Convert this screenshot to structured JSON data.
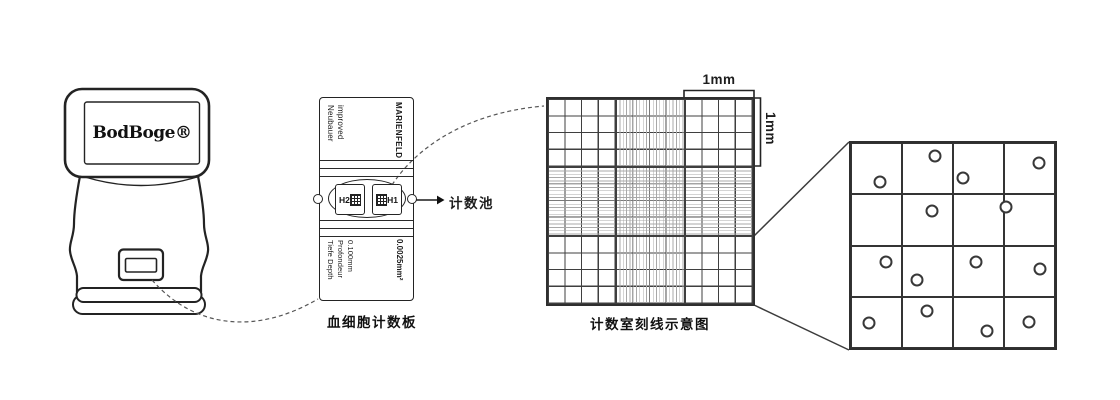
{
  "device": {
    "logo": "BodBoge®"
  },
  "slide": {
    "brand_lines": [
      "Neubauer",
      "improved"
    ],
    "maker": "MARIENFELD",
    "chamber_left_label": "H2",
    "chamber_right_label": "H1",
    "pointer_label": "计数池",
    "depth_lines": [
      "Tiefe Depth",
      "Profondeur",
      "0.100mm"
    ],
    "area_label": "0.0025mm²",
    "caption": "血细胞计数板"
  },
  "grid_diagram": {
    "caption": "计数室刻线示意图",
    "dim_top": "1mm",
    "dim_right": "1mm"
  },
  "magnified_view": {
    "rows": 4,
    "cols": 4,
    "dot_count": 14,
    "dots": [
      {
        "x": 29,
        "y": 39
      },
      {
        "x": 84,
        "y": 13
      },
      {
        "x": 112,
        "y": 35
      },
      {
        "x": 188,
        "y": 20
      },
      {
        "x": 81,
        "y": 68
      },
      {
        "x": 155,
        "y": 64
      },
      {
        "x": 35,
        "y": 119
      },
      {
        "x": 66,
        "y": 137
      },
      {
        "x": 125,
        "y": 119
      },
      {
        "x": 189,
        "y": 126
      },
      {
        "x": 18,
        "y": 180
      },
      {
        "x": 76,
        "y": 168
      },
      {
        "x": 136,
        "y": 188
      },
      {
        "x": 178,
        "y": 179
      }
    ]
  },
  "colors": {
    "outline": "#232323",
    "coarse_line": "#3f3f3f",
    "fine_line": "#a8a8a8",
    "background": "#ffffff"
  }
}
